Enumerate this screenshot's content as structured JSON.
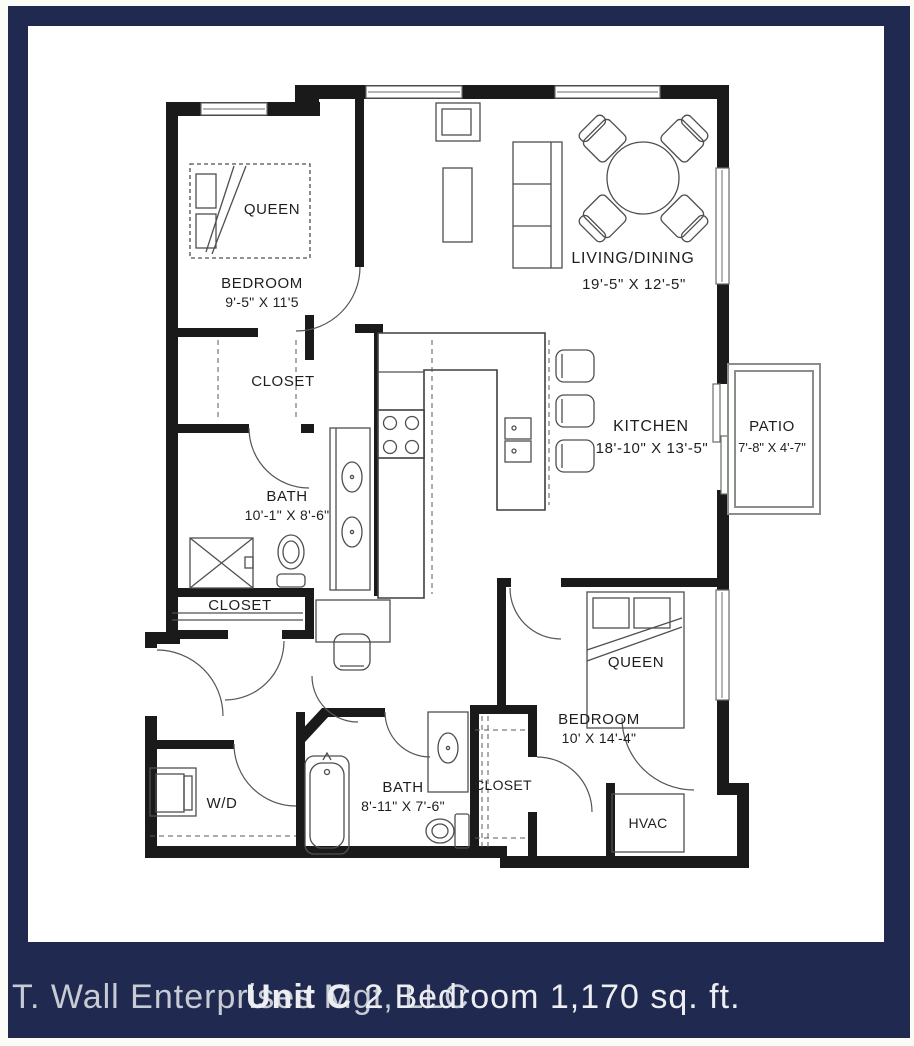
{
  "footer": {
    "company": "T. Wall Enterprises Mgt, LLC",
    "unit_name": "Unit C",
    "unit_details": "2 Bedroom 1,170 sq. ft."
  },
  "palette": {
    "frame_navy": "#20294f",
    "wall_black": "#1a1a1a",
    "paper_white": "#ffffff"
  },
  "rooms": {
    "bedroom1": {
      "label": "BEDROOM",
      "dims": "9'-5\" X 11'5",
      "bed": "QUEEN"
    },
    "closet1": {
      "label": "CLOSET"
    },
    "bath1": {
      "label": "BATH",
      "dims": "10'-1\" X 8'-6\""
    },
    "closet2": {
      "label": "CLOSET"
    },
    "living": {
      "label": "LIVING/DINING",
      "dims": "19'-5\" X 12'-5\""
    },
    "kitchen": {
      "label": "KITCHEN",
      "dims": "18'-10\" X 13'-5\""
    },
    "patio": {
      "label": "PATIO",
      "dims": "7'-8\" X 4'-7\""
    },
    "laundry": {
      "label": "W/D"
    },
    "bath2": {
      "label": "BATH",
      "dims": "8'-11\" X 7'-6\""
    },
    "closet3": {
      "label": "CLOSET"
    },
    "bedroom2": {
      "label": "BEDROOM",
      "dims": "10' X 14'-4\"",
      "bed": "QUEEN"
    },
    "hvac": {
      "label": "HVAC"
    }
  }
}
